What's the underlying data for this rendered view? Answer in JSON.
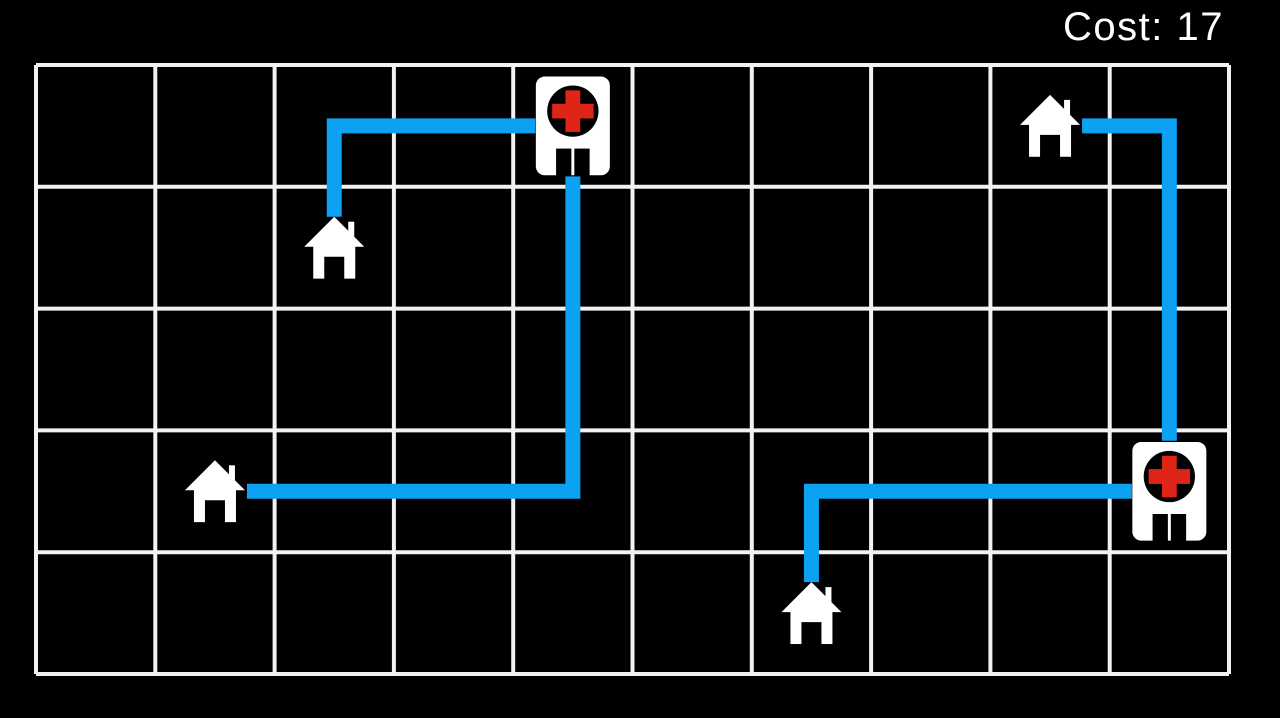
{
  "hud": {
    "cost_text": "Cost: 17",
    "cost_value": 17
  },
  "colors": {
    "background": "#000000",
    "grid_line": "#f2f2f2",
    "path_blue": "#0da1f2",
    "building_white": "#ffffff",
    "cross_red": "#df2518",
    "icon_ink": "#000000",
    "hud_text": "#ffffff"
  },
  "board": {
    "cols": 10,
    "rows": 5,
    "entities": [
      {
        "id": "hospital-1",
        "type": "hospital",
        "col": 4,
        "row": 0
      },
      {
        "id": "hospital-2",
        "type": "hospital",
        "col": 9,
        "row": 3
      },
      {
        "id": "house-1",
        "type": "house",
        "col": 2,
        "row": 1
      },
      {
        "id": "house-2",
        "type": "house",
        "col": 1,
        "row": 3
      },
      {
        "id": "house-3",
        "type": "house",
        "col": 8,
        "row": 0
      },
      {
        "id": "house-4",
        "type": "house",
        "col": 6,
        "row": 4
      }
    ],
    "connections": [
      {
        "id": "route-house1-hospital1",
        "from": "house-1",
        "to": "hospital-1",
        "cells": [
          [
            2,
            1
          ],
          [
            2,
            0
          ],
          [
            4,
            0
          ]
        ],
        "cost": 3
      },
      {
        "id": "route-hospital1-house2",
        "from": "hospital-1",
        "to": "house-2",
        "cells": [
          [
            4,
            0
          ],
          [
            4,
            3
          ],
          [
            1,
            3
          ]
        ],
        "cost": 6
      },
      {
        "id": "route-house3-hospital2",
        "from": "house-3",
        "to": "hospital-2",
        "cells": [
          [
            8,
            0
          ],
          [
            9,
            0
          ],
          [
            9,
            3
          ]
        ],
        "cost": 4
      },
      {
        "id": "route-house4-hospital2",
        "from": "house-4",
        "to": "hospital-2",
        "cells": [
          [
            6,
            4
          ],
          [
            6,
            3
          ],
          [
            9,
            3
          ]
        ],
        "cost": 4
      }
    ],
    "total_cost": 17
  }
}
